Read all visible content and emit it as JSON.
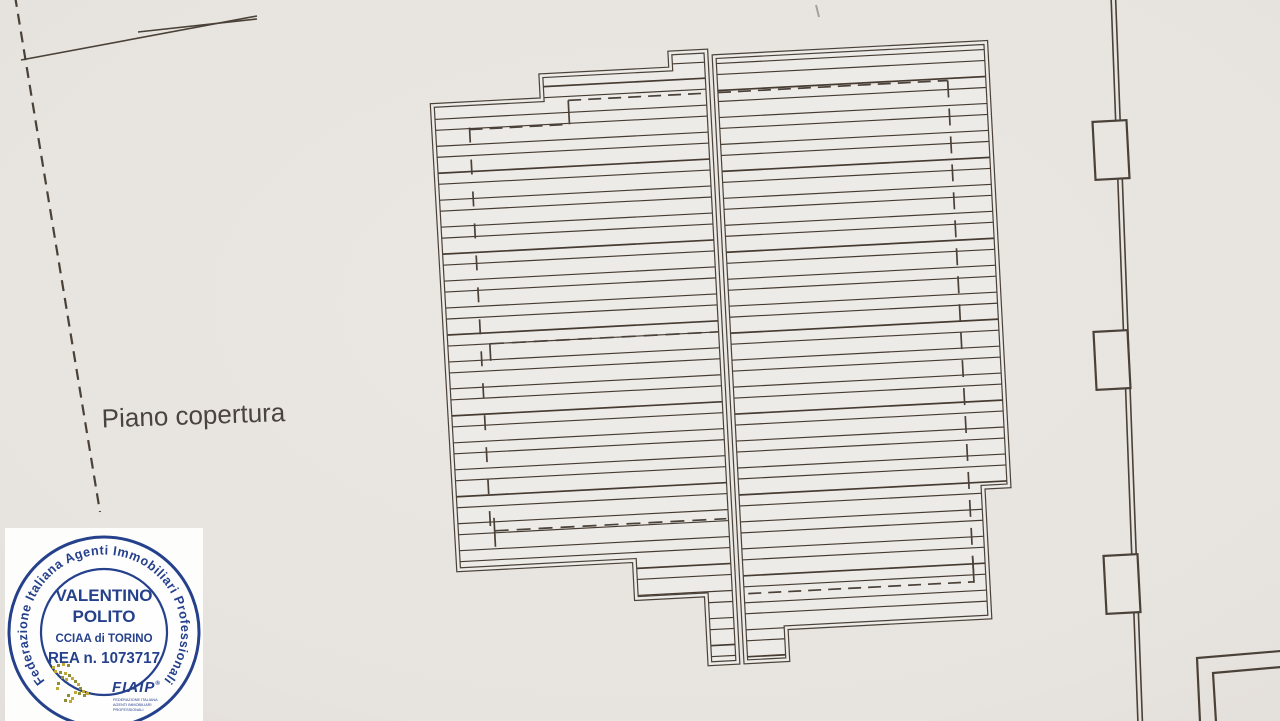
{
  "page": {
    "kind": "scanned roof plan drawing",
    "label": "Piano copertura"
  },
  "stamp": {
    "circular_text": "Federazione Italiana Agenti Immobiliari Professionali",
    "name_line1": "VALENTINO",
    "name_line2": "POLITO",
    "cciaa": "CCIAA di TORINO",
    "rea": "REA n. 1073717",
    "logo_text": "FIAIP",
    "logo_reg": "®",
    "logo_subtext_lines": [
      "FEDERAZIONE ITALIANA",
      "AGENTI IMMOBILIARI",
      "PROFESSIONALI"
    ],
    "accent_color": "#26418c"
  },
  "drawing": {
    "rotation_deg": -3,
    "rotation_center": [
      716,
      360
    ],
    "plan_offset": [
      446,
      51
    ],
    "colors": {
      "paper": "#e9e5e1",
      "roof_fill": "#edebe8",
      "line": "#4a4138",
      "hatch": "#453b31",
      "faint": "#a8a09a"
    },
    "hatch": {
      "period": 27,
      "pair_offset": 11,
      "line_w": 1.15,
      "heavy_w": 1.7
    },
    "pitches": [
      {
        "name": "left-roof-pitch",
        "points": [
          [
            0,
            40
          ],
          [
            110,
            40
          ],
          [
            110,
            16
          ],
          [
            240,
            16
          ],
          [
            240,
            0
          ],
          [
            276,
            0
          ],
          [
            276,
            612
          ],
          [
            248,
            612
          ],
          [
            248,
            543
          ],
          [
            178,
            543
          ],
          [
            178,
            505
          ],
          [
            2,
            505
          ]
        ],
        "phase": 0,
        "dashes": [
          {
            "x1": 36,
            "y1": 64,
            "x2": 36,
            "y2": 470,
            "pat": "15 17"
          },
          {
            "x1": 36,
            "y1": 66,
            "x2": 136,
            "y2": 66,
            "pat": "13 7"
          },
          {
            "x1": 136,
            "y1": 66,
            "x2": 136,
            "y2": 42
          },
          {
            "x1": 136,
            "y1": 42,
            "x2": 272,
            "y2": 42,
            "pat": "13 7"
          },
          {
            "x1": 45,
            "y1": 281,
            "x2": 274,
            "y2": 281,
            "pat": "14 8"
          },
          {
            "x1": 45,
            "y1": 281,
            "x2": 45,
            "y2": 298
          },
          {
            "x1": 40,
            "y1": 468,
            "x2": 272,
            "y2": 468,
            "pat": "14 8"
          },
          {
            "x1": 40,
            "y1": 455,
            "x2": 40,
            "y2": 484
          }
        ]
      },
      {
        "name": "right-roof-pitch",
        "points": [
          [
            284,
            6
          ],
          [
            556,
            6
          ],
          [
            556,
            450
          ],
          [
            530,
            450
          ],
          [
            530,
            580
          ],
          [
            326,
            580
          ],
          [
            326,
            612
          ],
          [
            284,
            612
          ]
        ],
        "phase": 7,
        "dashes": [
          {
            "x1": 516,
            "y1": 42,
            "x2": 516,
            "y2": 544,
            "pat": "17 11"
          },
          {
            "x1": 286,
            "y1": 42,
            "x2": 516,
            "y2": 42,
            "pat": "13 7"
          },
          {
            "x1": 290,
            "y1": 544,
            "x2": 516,
            "y2": 544,
            "pat": "13 7"
          },
          {
            "x1": 516,
            "y1": 518,
            "x2": 516,
            "y2": 545
          }
        ]
      }
    ],
    "site_lines": [
      {
        "name": "boundary-dashed-line",
        "x1": 15,
        "y1": -4,
        "x2": 100,
        "y2": 512,
        "w": 2.2,
        "pat": "11 7"
      },
      {
        "name": "boundary-line-a",
        "x1": 21,
        "y1": 60,
        "x2": 257,
        "y2": 16,
        "w": 1.6
      },
      {
        "name": "boundary-line-b",
        "x1": 138,
        "y1": 32,
        "x2": 257,
        "y2": 19,
        "w": 1.6
      },
      {
        "name": "neighbor-wall-line-1",
        "x1": 1111,
        "y1": -5,
        "x2": 1138,
        "y2": 724,
        "w": 1.6
      },
      {
        "name": "neighbor-wall-line-2",
        "x1": 1115.5,
        "y1": -5,
        "x2": 1142.5,
        "y2": 724,
        "w": 1.6
      },
      {
        "name": "corner-wall-outer",
        "pts": [
          [
            1281,
            651
          ],
          [
            1197,
            658
          ],
          [
            1200,
            722
          ]
        ],
        "w": 2.2
      },
      {
        "name": "corner-wall-inner",
        "pts": [
          [
            1281,
            667
          ],
          [
            1213,
            673
          ],
          [
            1216,
            722
          ]
        ],
        "w": 2.2
      },
      {
        "name": "stray-mark",
        "x1": 816,
        "y1": 5,
        "x2": 819,
        "y2": 17,
        "w": 2,
        "faint": true
      }
    ],
    "pillars": [
      {
        "cx": 1111,
        "cy": 150
      },
      {
        "cx": 1112,
        "cy": 360
      },
      {
        "cx": 1122,
        "cy": 584
      }
    ],
    "pillar_size": [
      34,
      58
    ],
    "label": {
      "x": 102,
      "y": 424,
      "size": 26
    }
  }
}
